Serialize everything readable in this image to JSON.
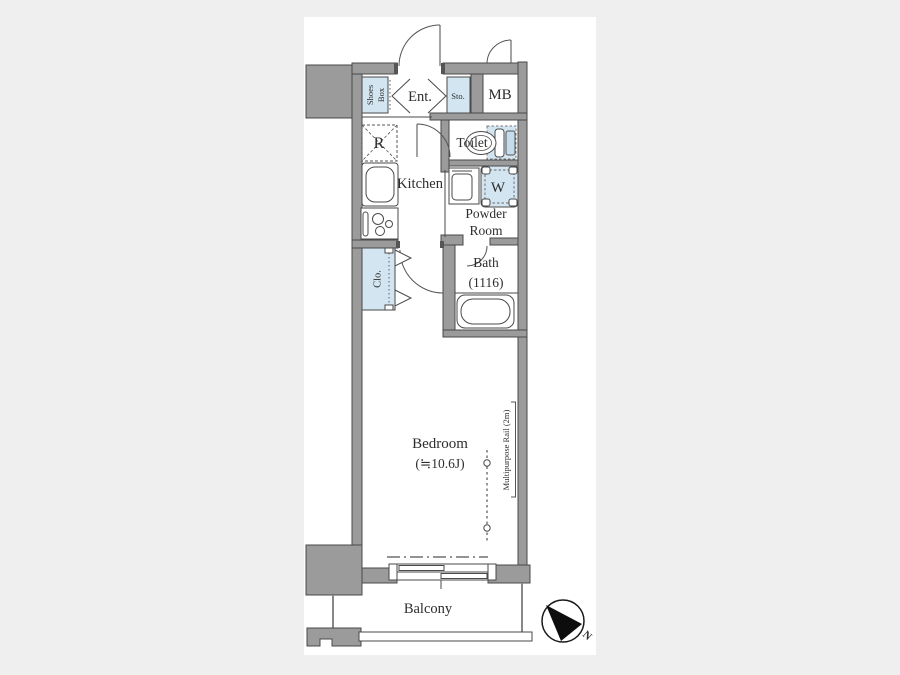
{
  "colors": {
    "page_background": "#efefef",
    "canvas": "#ffffff",
    "wall_fill": "#9b9b9b",
    "wall_outline": "#4a4a4a",
    "fixture_blue": "#d3e5f1",
    "text": "#2d2d2d"
  },
  "plan": {
    "entrance": "Ent.",
    "shoes_box_line1": "Shoes",
    "shoes_box_line2": "Box",
    "storage": "Sto.",
    "meter_box": "MB",
    "refrigerator": "R",
    "kitchen": "Kitchen",
    "toilet": "Toilet",
    "washer": "W",
    "powder_line1": "Powder",
    "powder_line2": "Room",
    "bath_line1": "Bath",
    "bath_line2": "(1116)",
    "closet": "Clo.",
    "bedroom_line1": "Bedroom",
    "bedroom_line2": "(≒10.6J)",
    "rail_note": "Multipurpose Rail (2m)",
    "balcony": "Balcony",
    "compass_north": "N"
  }
}
